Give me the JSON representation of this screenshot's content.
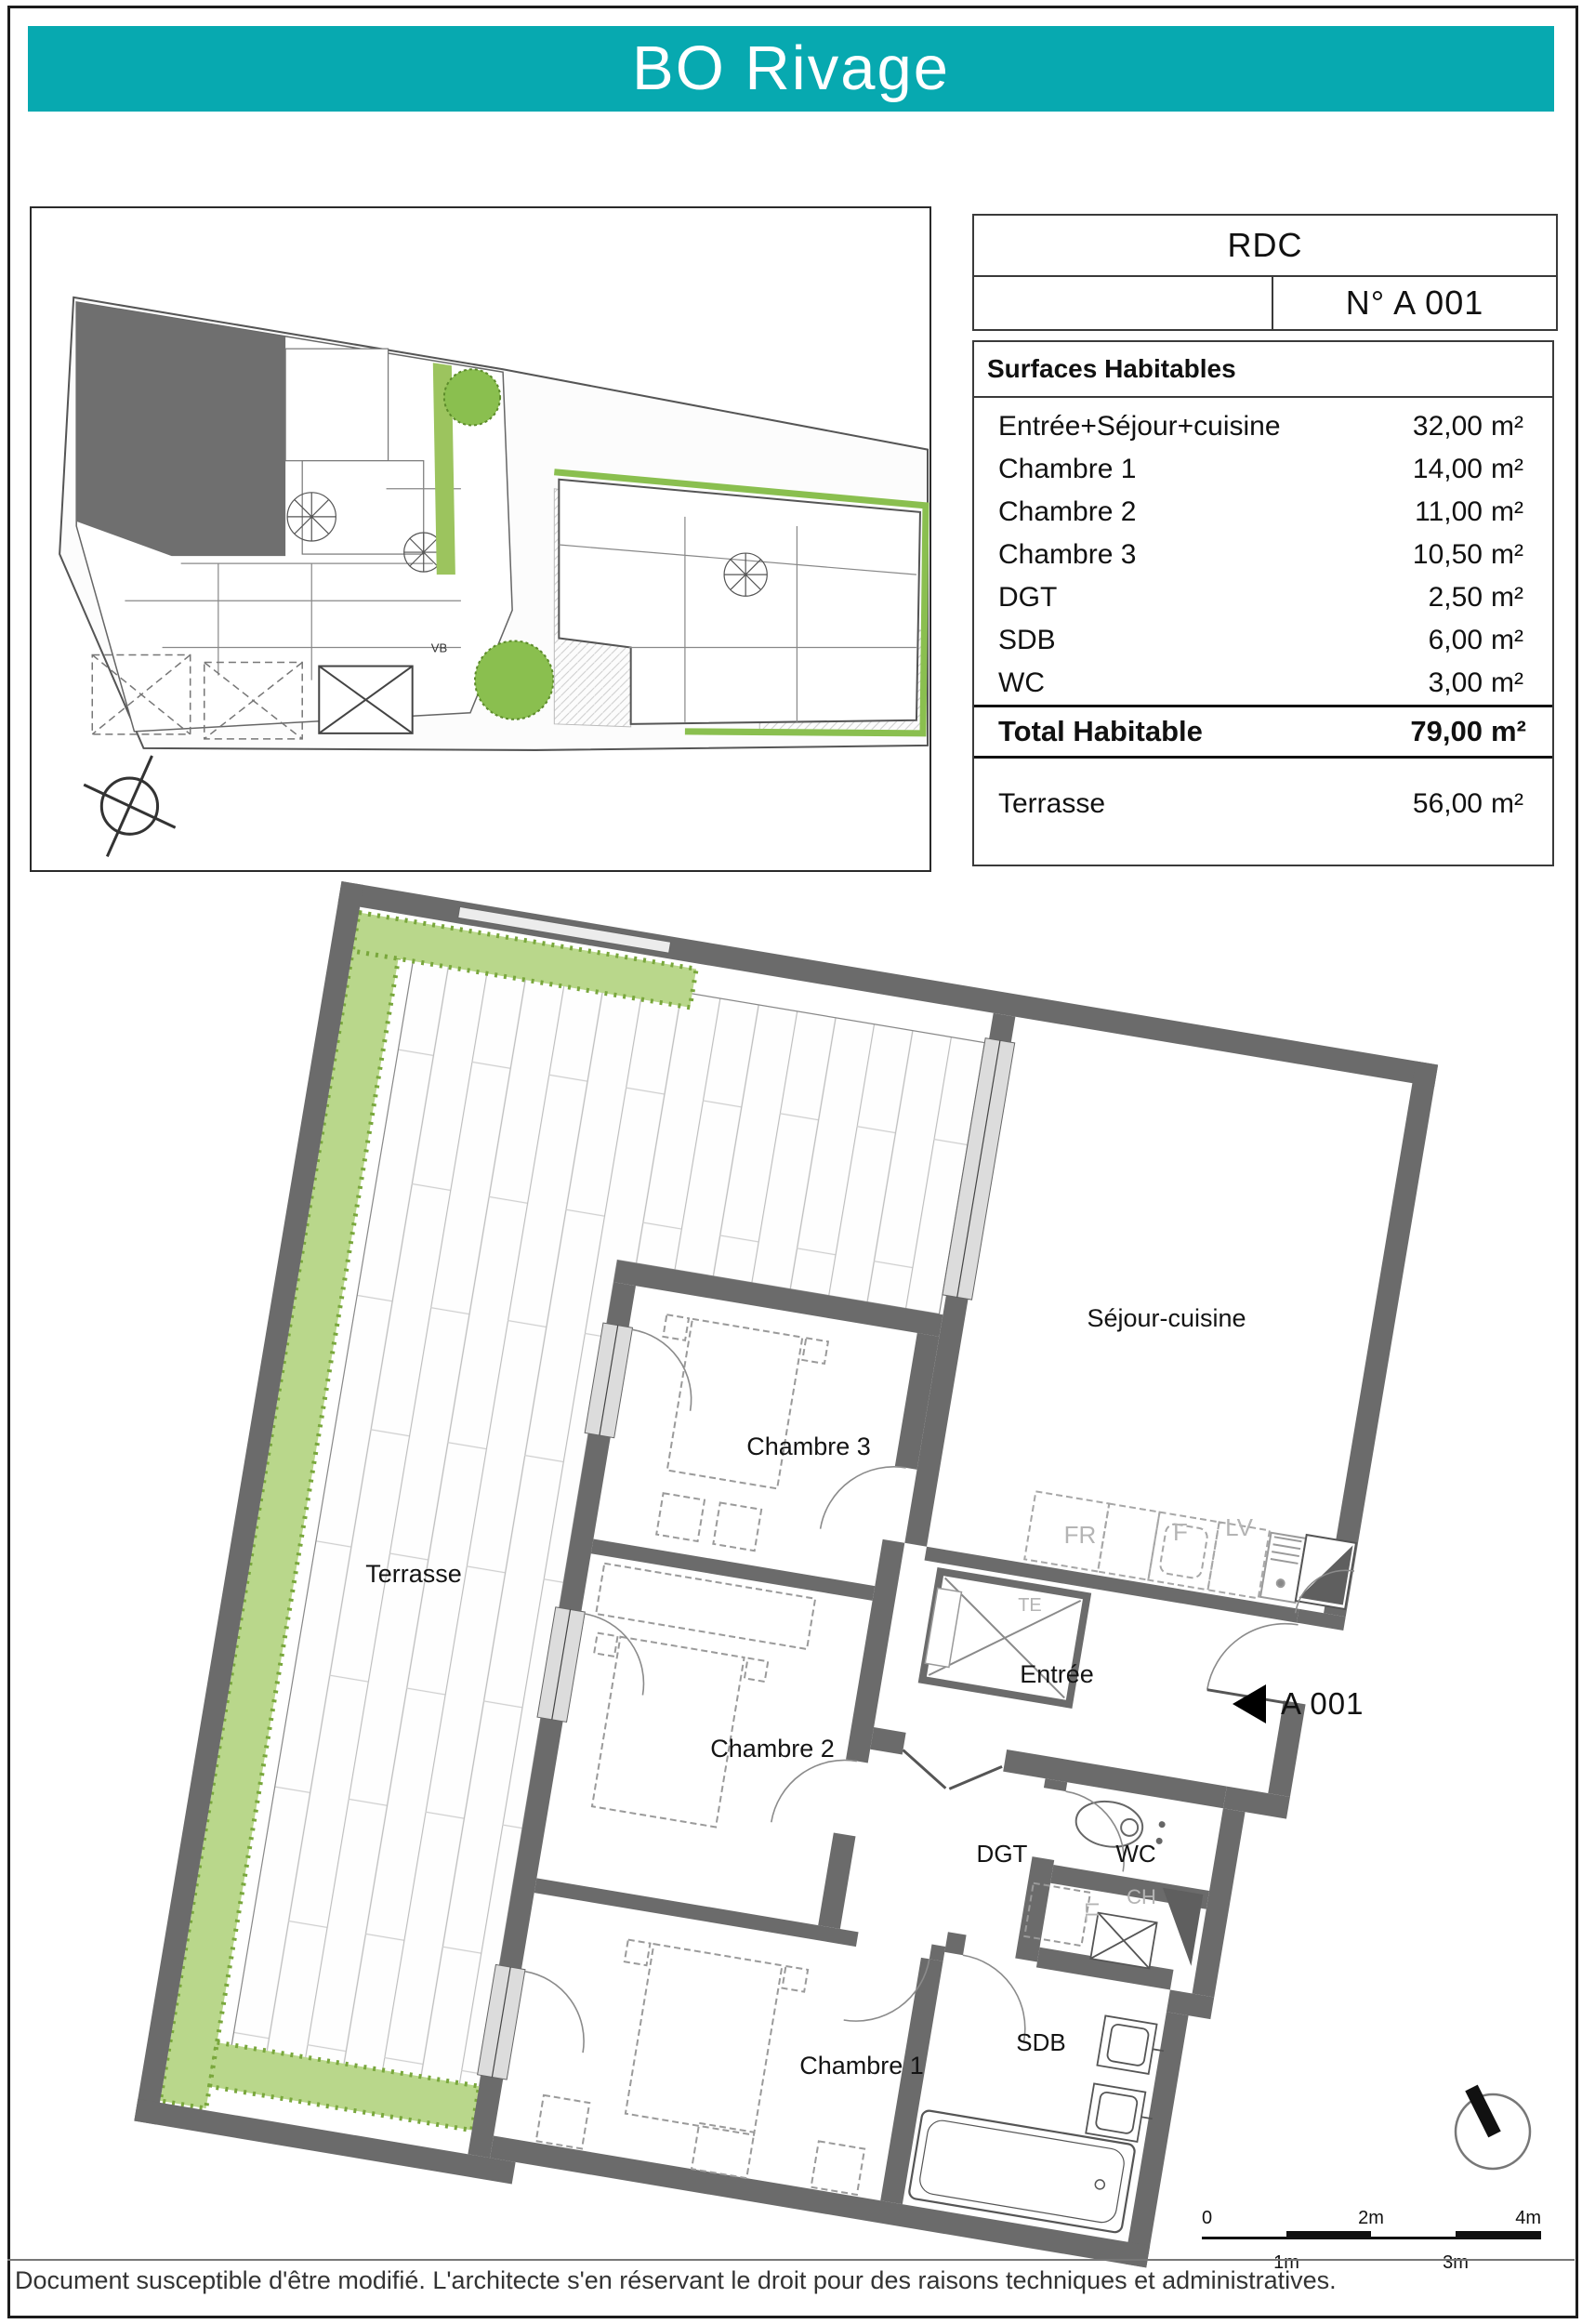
{
  "banner": {
    "title": "BO Rivage",
    "color": "#07a9b0"
  },
  "header_table": {
    "level": "RDC",
    "unit_number": "N° A 001"
  },
  "surfaces": {
    "title": "Surfaces Habitables",
    "unit": "m²",
    "rows": [
      {
        "label": "Entrée+Séjour+cuisine",
        "value": "32,00"
      },
      {
        "label": "Chambre 1",
        "value": "14,00"
      },
      {
        "label": "Chambre 2",
        "value": "11,00"
      },
      {
        "label": "Chambre 3",
        "value": "10,50"
      },
      {
        "label": "DGT",
        "value": "2,50"
      },
      {
        "label": "SDB",
        "value": "6,00"
      },
      {
        "label": "WC",
        "value": "3,00"
      }
    ],
    "total": {
      "label": "Total Habitable",
      "value": "79,00"
    },
    "terrace": {
      "label": "Terrasse",
      "value": "56,00"
    }
  },
  "floor_plan": {
    "rooms": {
      "sejour": "Séjour-cuisine",
      "chambre3": "Chambre 3",
      "chambre2": "Chambre 2",
      "chambre1": "Chambre 1",
      "terrasse": "Terrasse",
      "entree": "Entrée",
      "dgt": "DGT",
      "wc": "WC",
      "sdb": "SDB"
    },
    "appliances": {
      "fr": "FR",
      "f": "F",
      "lv": "LV",
      "te": "TE",
      "ll": "LL",
      "ch": "CH"
    },
    "unit_marker": "A 001",
    "site_label_vb": "VB"
  },
  "scale_bar": {
    "labels_top": [
      "0",
      "2m",
      "4m"
    ],
    "labels_bottom": [
      "1m",
      "3m"
    ]
  },
  "footer": {
    "disclaimer": "Document susceptible d'être modifié. L'architecte s'en réservant le droit pour des raisons techniques et administratives."
  }
}
